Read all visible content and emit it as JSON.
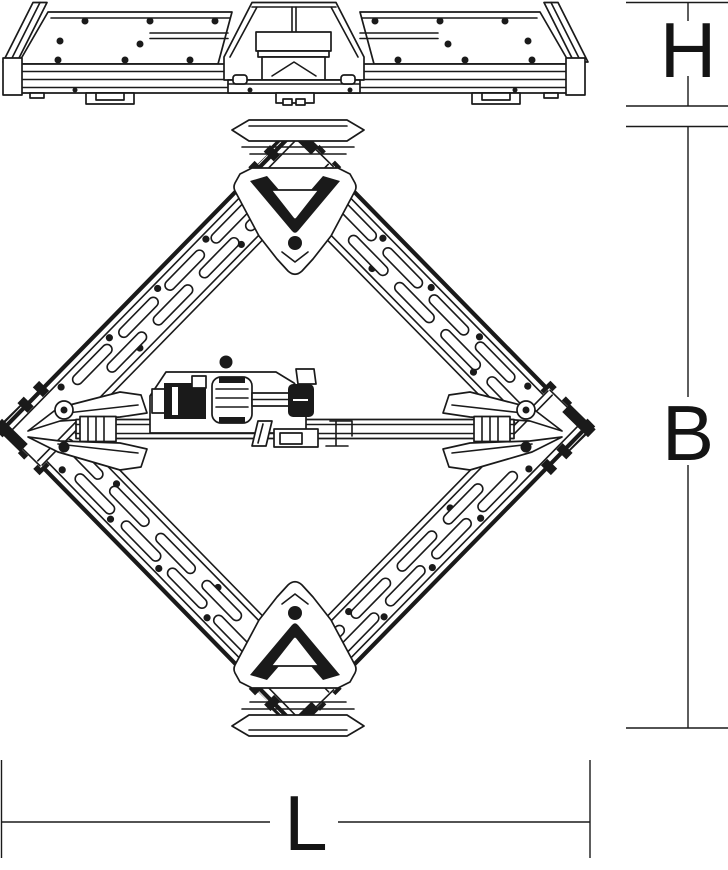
{
  "document": {
    "type": "technical-dimensional-drawing",
    "background_color": "#ffffff",
    "line_color": "#1a1a1a"
  },
  "views": {
    "side_view": {
      "name": "folded unit - side elevation"
    },
    "plan_view": {
      "name": "unfolded unit - top view (diamond)"
    }
  },
  "dimension_labels": {
    "height": "H",
    "depth": "B",
    "length": "L"
  }
}
